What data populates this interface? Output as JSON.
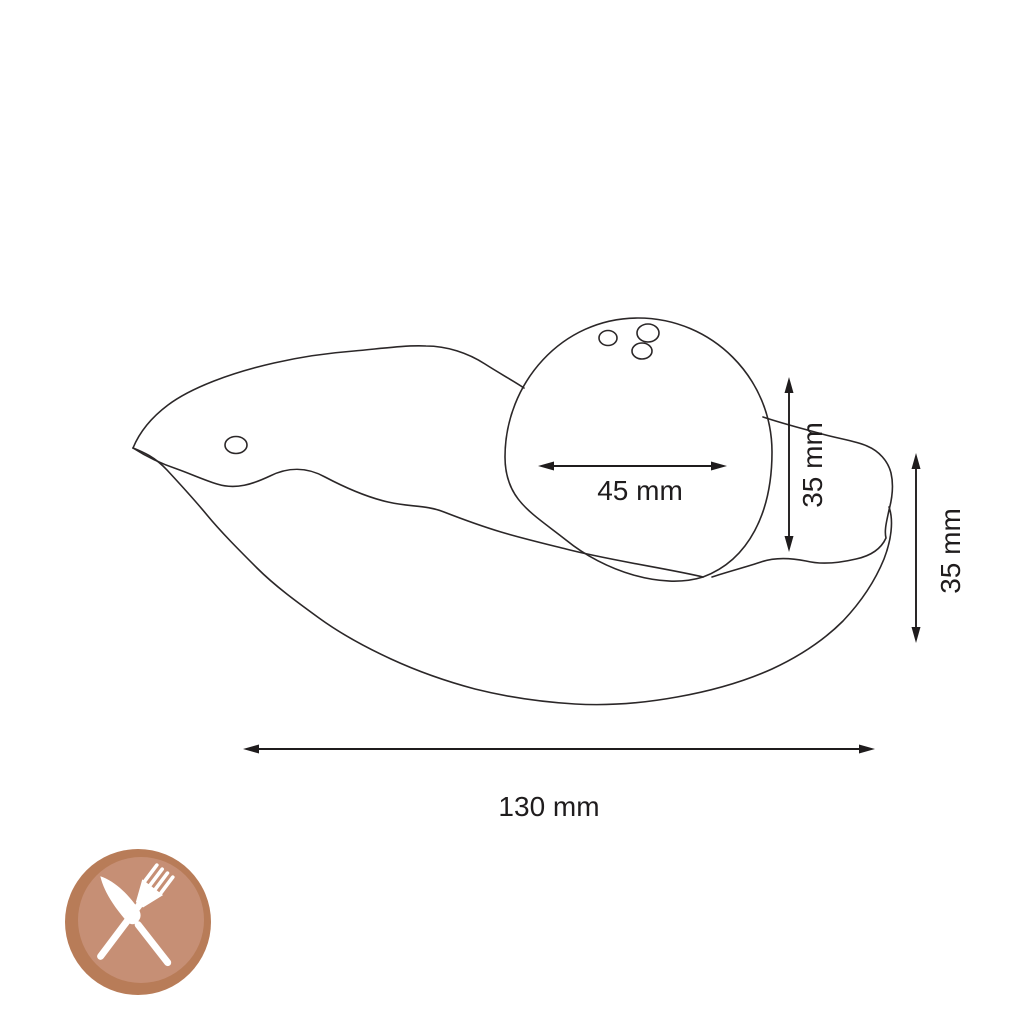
{
  "diagram": {
    "dimensions": {
      "ball_width": "45 mm",
      "ball_height": "35 mm",
      "shell_height": "35 mm",
      "shell_width": "130 mm"
    }
  },
  "badge": {
    "icon": "fork-and-knife-icon",
    "ring_color": "#b87c58",
    "face_color": "#c68f75",
    "glyph_color": "#ffffff"
  },
  "style": {
    "line_color": "#2b2728",
    "background": "#ffffff"
  }
}
